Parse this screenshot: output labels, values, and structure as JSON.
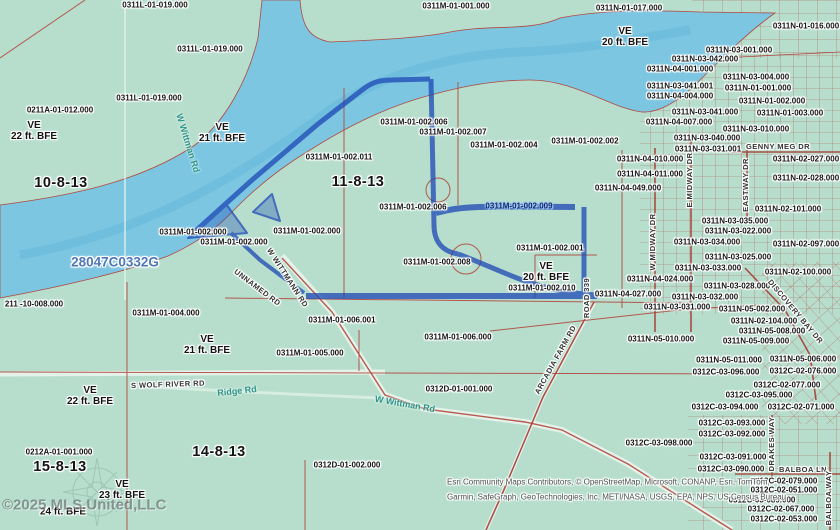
{
  "map": {
    "title": "parcel-flood-map",
    "firm_panel": "28047C0332G",
    "watermark": "©2025 MLS United,LLC",
    "attribution": [
      "Esri Community Maps Contributors, © OpenStreetMap, Microsoft, CONANP, Esri, TomTom,",
      "Garmin, SafeGraph, GeoTechnologies, Inc, METI/NASA, USGS, EPA, NPS, US Census Bureau,"
    ],
    "colors": {
      "land": "#b7decd",
      "water": "#7cc6e2",
      "parcel_line": "#b2483e",
      "selection": "#1c47b4",
      "firm_text": "#4d77b8",
      "basemap_road_text": "#2d9488"
    },
    "sections": [
      "10-8-13",
      "11-8-13",
      "15-8-13",
      "14-8-13"
    ],
    "flood_zones": [
      "VE 20 ft. BFE",
      "VE 21 ft. BFE",
      "VE 22 ft. BFE",
      "VE 23 ft. BFE",
      "VE 24 ft. BFE"
    ],
    "labels": [
      {
        "t": "0311L-01-019.000",
        "x": 155,
        "y": 6,
        "k": "p"
      },
      {
        "t": "0311M-01-001.000",
        "x": 456,
        "y": 7,
        "k": "p"
      },
      {
        "t": "0311N-01-017.000",
        "x": 629,
        "y": 9,
        "k": "p"
      },
      {
        "t": "0311N-01-016.000",
        "x": 806,
        "y": 27,
        "k": "p"
      },
      {
        "t": "0311L-01-019.000",
        "x": 210,
        "y": 50,
        "k": "p"
      },
      {
        "t": "VE\n20 ft. BFE",
        "x": 625,
        "y": 37,
        "k": "f"
      },
      {
        "t": "0311N-03-001.000",
        "x": 739,
        "y": 51,
        "k": "p"
      },
      {
        "t": "0311N-03-042.000",
        "x": 705,
        "y": 60,
        "k": "p"
      },
      {
        "t": "0311N-04-001.000",
        "x": 680,
        "y": 70,
        "k": "p"
      },
      {
        "t": "0311N-03-004.000",
        "x": 756,
        "y": 78,
        "k": "p"
      },
      {
        "t": "0311N-03-041.001",
        "x": 680,
        "y": 87,
        "k": "p"
      },
      {
        "t": "0311N-01-001.000",
        "x": 758,
        "y": 89,
        "k": "p"
      },
      {
        "t": "0311N-04-004.000",
        "x": 680,
        "y": 97,
        "k": "p"
      },
      {
        "t": "0311L-01-019.000",
        "x": 149,
        "y": 99,
        "k": "p"
      },
      {
        "t": "0311N-01-002.000",
        "x": 772,
        "y": 102,
        "k": "p"
      },
      {
        "t": "0211A-01-012.000",
        "x": 60,
        "y": 111,
        "k": "p"
      },
      {
        "t": "0311N-03-041.000",
        "x": 705,
        "y": 113,
        "k": "p"
      },
      {
        "t": "0311N-01-003.000",
        "x": 790,
        "y": 114,
        "k": "p"
      },
      {
        "t": "0311N-04-007.000",
        "x": 679,
        "y": 123,
        "k": "p"
      },
      {
        "t": "0311M-01-002.006",
        "x": 414,
        "y": 123,
        "k": "p"
      },
      {
        "t": "VE\n22 ft. BFE",
        "x": 34,
        "y": 131,
        "k": "f"
      },
      {
        "t": "0311N-03-010.000",
        "x": 756,
        "y": 130,
        "k": "p"
      },
      {
        "t": "0311M-01-002.007",
        "x": 453,
        "y": 133,
        "k": "p"
      },
      {
        "t": "VE\n21 ft. BFE",
        "x": 222,
        "y": 133,
        "k": "f"
      },
      {
        "t": "0311N-03-040.000",
        "x": 707,
        "y": 139,
        "k": "p"
      },
      {
        "t": "0311M-01-002.004",
        "x": 504,
        "y": 146,
        "k": "p"
      },
      {
        "t": "0311M-01-002.002",
        "x": 585,
        "y": 142,
        "k": "p"
      },
      {
        "t": "GENNY MEG DR",
        "x": 778,
        "y": 147,
        "k": "rd"
      },
      {
        "t": "0311N-03-031.001",
        "x": 708,
        "y": 150,
        "k": "p"
      },
      {
        "t": "W Wittman Rd",
        "x": 188,
        "y": 143,
        "k": "rt",
        "r": 73
      },
      {
        "t": "0311M-01-002.011",
        "x": 339,
        "y": 158,
        "k": "p"
      },
      {
        "t": "0311N-04-010.000",
        "x": 650,
        "y": 160,
        "k": "p"
      },
      {
        "t": "0311N-02-027.000",
        "x": 806,
        "y": 160,
        "k": "p"
      },
      {
        "t": "0311N-04-011.000",
        "x": 650,
        "y": 175,
        "k": "p"
      },
      {
        "t": "0311N-02-028.000",
        "x": 806,
        "y": 179,
        "k": "p"
      },
      {
        "t": "10-8-13",
        "x": 61,
        "y": 183,
        "k": "s"
      },
      {
        "t": "11-8-13",
        "x": 358,
        "y": 182,
        "k": "s"
      },
      {
        "t": "0311N-04-049.000",
        "x": 628,
        "y": 189,
        "k": "p"
      },
      {
        "t": "E MIDWAY DR",
        "x": 690,
        "y": 180,
        "k": "rd",
        "r": -90
      },
      {
        "t": "EASTWAY DR",
        "x": 746,
        "y": 185,
        "k": "rd",
        "r": -90
      },
      {
        "t": "0311M-01-002.006",
        "x": 413,
        "y": 208,
        "k": "p"
      },
      {
        "t": "0311M-01-002.009",
        "x": 519,
        "y": 207,
        "k": "pb"
      },
      {
        "t": "0311N-02-101.000",
        "x": 788,
        "y": 210,
        "k": "p"
      },
      {
        "t": "0311N-03-035.000",
        "x": 735,
        "y": 222,
        "k": "p"
      },
      {
        "t": "0311M-01-002.000",
        "x": 193,
        "y": 233,
        "k": "p"
      },
      {
        "t": "0311M-01-002.000",
        "x": 307,
        "y": 232,
        "k": "p"
      },
      {
        "t": "0311N-03-022.000",
        "x": 738,
        "y": 232,
        "k": "p"
      },
      {
        "t": "0311M-01-002.000",
        "x": 234,
        "y": 243,
        "k": "p"
      },
      {
        "t": "0311N-03-034.000",
        "x": 707,
        "y": 243,
        "k": "p"
      },
      {
        "t": "0311N-02-097.000",
        "x": 806,
        "y": 245,
        "k": "p"
      },
      {
        "t": "W MIDWAY DR",
        "x": 653,
        "y": 242,
        "k": "rd",
        "r": -90
      },
      {
        "t": "0311M-01-002.001",
        "x": 550,
        "y": 249,
        "k": "p"
      },
      {
        "t": "0311N-03-025.000",
        "x": 738,
        "y": 258,
        "k": "p"
      },
      {
        "t": "28047C0332G",
        "x": 115,
        "y": 262,
        "k": "firm"
      },
      {
        "t": "VE\n20 ft. BFE",
        "x": 546,
        "y": 272,
        "k": "f"
      },
      {
        "t": "0311M-01-002.008",
        "x": 437,
        "y": 263,
        "k": "p"
      },
      {
        "t": "0311N-03-033.000",
        "x": 708,
        "y": 269,
        "k": "p"
      },
      {
        "t": "0311N-02-100.000",
        "x": 798,
        "y": 273,
        "k": "p"
      },
      {
        "t": "W WITTMANN RD",
        "x": 287,
        "y": 278,
        "k": "rd",
        "r": 57
      },
      {
        "t": "UNNAMED RD",
        "x": 257,
        "y": 288,
        "k": "rd",
        "r": 37
      },
      {
        "t": "0311N-04-024.000",
        "x": 660,
        "y": 280,
        "k": "p"
      },
      {
        "t": "0311N-03-028.000",
        "x": 737,
        "y": 287,
        "k": "p"
      },
      {
        "t": "0311M-01-002.010",
        "x": 542,
        "y": 289,
        "k": "p"
      },
      {
        "t": "ROAD 339",
        "x": 587,
        "y": 298,
        "k": "rd",
        "r": -90
      },
      {
        "t": "0311N-04-027.000",
        "x": 628,
        "y": 295,
        "k": "p"
      },
      {
        "t": "0311N-03-032.000",
        "x": 705,
        "y": 298,
        "k": "p"
      },
      {
        "t": "DISCOVERY BAY DR",
        "x": 795,
        "y": 312,
        "k": "rd",
        "r": 50
      },
      {
        "t": "211 -10-008.000",
        "x": 34,
        "y": 305,
        "k": "p"
      },
      {
        "t": "0311N-03-031.000",
        "x": 677,
        "y": 308,
        "k": "p"
      },
      {
        "t": "0311N-05-002.000",
        "x": 752,
        "y": 310,
        "k": "p"
      },
      {
        "t": "0311M-01-004.000",
        "x": 166,
        "y": 314,
        "k": "p"
      },
      {
        "t": "0311M-01-006.001",
        "x": 342,
        "y": 321,
        "k": "p"
      },
      {
        "t": "0311N-02-104.000",
        "x": 764,
        "y": 322,
        "k": "p"
      },
      {
        "t": "0311N-05-008.000",
        "x": 772,
        "y": 332,
        "k": "p"
      },
      {
        "t": "0311M-01-006.000",
        "x": 458,
        "y": 338,
        "k": "p"
      },
      {
        "t": "0311N-05-010.000",
        "x": 661,
        "y": 340,
        "k": "p"
      },
      {
        "t": "0311N-05-009.000",
        "x": 756,
        "y": 342,
        "k": "p"
      },
      {
        "t": "VE\n21 ft. BFE",
        "x": 207,
        "y": 345,
        "k": "f"
      },
      {
        "t": "0311M-01-005.000",
        "x": 310,
        "y": 354,
        "k": "p"
      },
      {
        "t": "0311N-05-011.000",
        "x": 729,
        "y": 361,
        "k": "p"
      },
      {
        "t": "0311N-05-006.000",
        "x": 803,
        "y": 360,
        "k": "p"
      },
      {
        "t": "ARCADIA FARM RD",
        "x": 556,
        "y": 360,
        "k": "rd",
        "r": -61
      },
      {
        "t": "0312C-03-096.000",
        "x": 726,
        "y": 373,
        "k": "p"
      },
      {
        "t": "0312C-02-076.000",
        "x": 803,
        "y": 372,
        "k": "p"
      },
      {
        "t": "S WOLF RIVER RD",
        "x": 168,
        "y": 385,
        "k": "rd",
        "r": -2
      },
      {
        "t": "Ridge Rd",
        "x": 237,
        "y": 391,
        "k": "rt",
        "r": -6
      },
      {
        "t": "0312C-02-077.000",
        "x": 787,
        "y": 386,
        "k": "p"
      },
      {
        "t": "0312D-01-001.000",
        "x": 459,
        "y": 390,
        "k": "p"
      },
      {
        "t": "VE\n22 ft. BFE",
        "x": 90,
        "y": 396,
        "k": "f"
      },
      {
        "t": "0312C-03-095.000",
        "x": 759,
        "y": 396,
        "k": "p"
      },
      {
        "t": "W Wittman Rd",
        "x": 405,
        "y": 404,
        "k": "rt",
        "r": 10
      },
      {
        "t": "0312C-03-094.000",
        "x": 725,
        "y": 408,
        "k": "p"
      },
      {
        "t": "0312C-02-071.000",
        "x": 801,
        "y": 408,
        "k": "p"
      },
      {
        "t": "0312C-03-093.000",
        "x": 732,
        "y": 424,
        "k": "p"
      },
      {
        "t": "0312C-03-092.000",
        "x": 732,
        "y": 435,
        "k": "p"
      },
      {
        "t": "DRAKES WAY",
        "x": 772,
        "y": 444,
        "k": "rd",
        "r": -90
      },
      {
        "t": "0312C-03-098.000",
        "x": 659,
        "y": 444,
        "k": "p"
      },
      {
        "t": "0212A-01-001.000",
        "x": 59,
        "y": 453,
        "k": "p"
      },
      {
        "t": "14-8-13",
        "x": 219,
        "y": 452,
        "k": "s"
      },
      {
        "t": "0312C-03-091.000",
        "x": 733,
        "y": 458,
        "k": "p"
      },
      {
        "t": "15-8-13",
        "x": 60,
        "y": 467,
        "k": "s"
      },
      {
        "t": "0312D-01-002.000",
        "x": 347,
        "y": 466,
        "k": "p"
      },
      {
        "t": "0312C-03-090.000",
        "x": 731,
        "y": 470,
        "k": "p"
      },
      {
        "t": "BALBOA LN",
        "x": 803,
        "y": 470,
        "k": "rd"
      },
      {
        "t": "0312C-02-079.000",
        "x": 784,
        "y": 482,
        "k": "p"
      },
      {
        "t": "VE\n23 ft. BFE",
        "x": 122,
        "y": 490,
        "k": "f"
      },
      {
        "t": "0312C-02-051.000",
        "x": 784,
        "y": 491,
        "k": "p"
      },
      {
        "t": "BALBOA WAY",
        "x": 829,
        "y": 498,
        "k": "rd",
        "r": -90
      },
      {
        "t": "0312C-03-089.000",
        "x": 762,
        "y": 501,
        "k": "p"
      },
      {
        "t": "0312C-02-067.000",
        "x": 781,
        "y": 510,
        "k": "p"
      },
      {
        "t": "24 ft. BFE",
        "x": 63,
        "y": 512,
        "k": "f"
      },
      {
        "t": "0312C-02-053.000",
        "x": 784,
        "y": 520,
        "k": "p"
      },
      {
        "t": "©2025 MLS United,LLC",
        "x": 2,
        "y": 506,
        "k": "w"
      },
      {
        "t": "Esri Community Maps Contributors, © OpenStreetMap, Microsoft, CONANP, Esri, TomTom,",
        "x": 447,
        "y": 483,
        "k": "at"
      },
      {
        "t": "Garmin, SafeGraph, GeoTechnologies, Inc, METI/NASA, USGS, EPA, NPS, US Census Bureau,",
        "x": 447,
        "y": 498,
        "k": "at"
      }
    ]
  }
}
